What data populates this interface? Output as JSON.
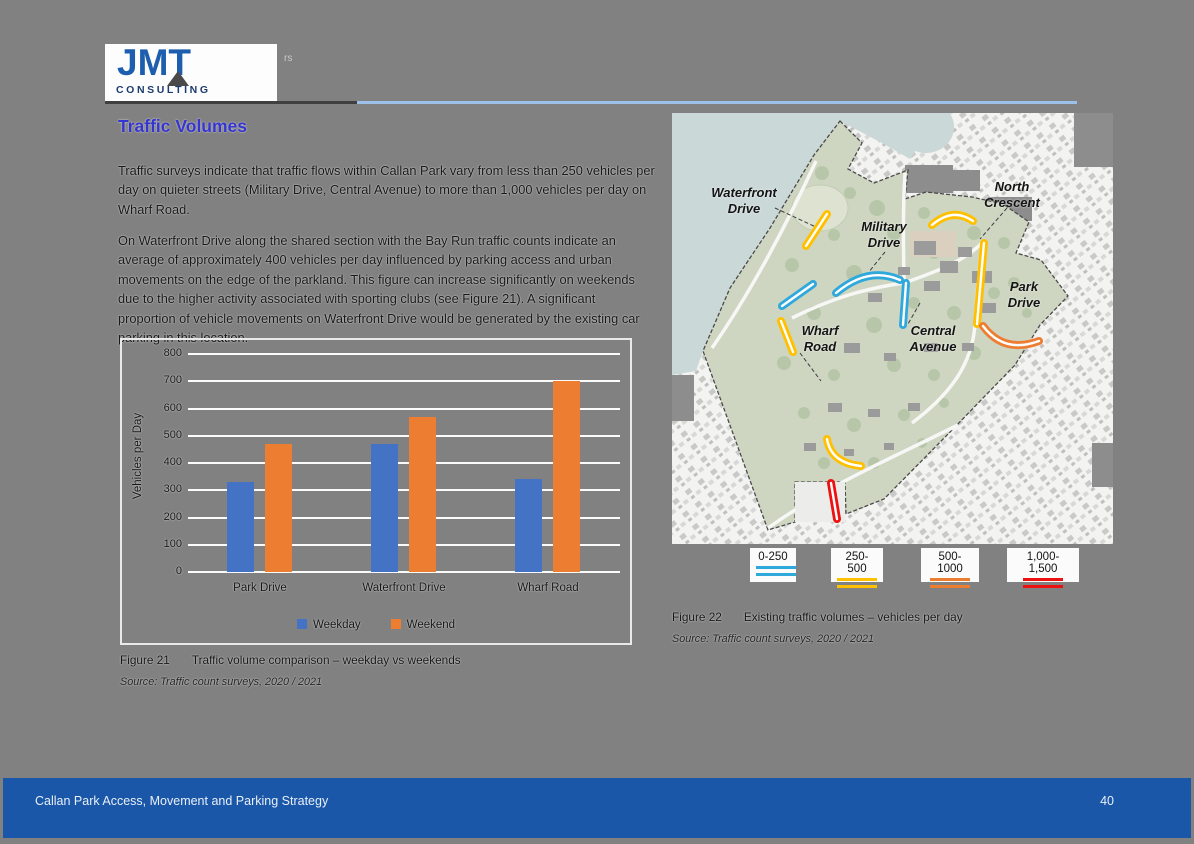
{
  "logo": {
    "brand": "JMT",
    "subtitle": "CONSULTING",
    "artifact": "rs"
  },
  "article": {
    "title": "Traffic Volumes",
    "paragraphs": [
      "Traffic surveys indicate that traffic flows within Callan Park vary from less than 250 vehicles per day on quieter streets (Military Drive, Central Avenue) to more than 1,000 vehicles per day on Wharf Road.",
      "On Waterfront Drive along the shared section with the Bay Run traffic counts indicate an average of approximately 400 vehicles per day influenced by parking access and urban movements on the edge of the parkland. This figure can increase significantly on weekends due to the higher activity associated with sporting clubs (see Figure 21). A significant proportion of vehicle movements on Waterfront Drive would be generated by the existing car parking in this location."
    ]
  },
  "chart_data": {
    "type": "bar",
    "categories": [
      "Park Drive",
      "Waterfront Drive",
      "Wharf Road"
    ],
    "series": [
      {
        "name": "Weekday",
        "color": "#4472C4",
        "values": [
          330,
          470,
          340
        ]
      },
      {
        "name": "Weekend",
        "color": "#ED7D31",
        "values": [
          470,
          570,
          700
        ]
      }
    ],
    "title": "",
    "xlabel": "",
    "ylabel": "Vehicles per Day",
    "ylim": [
      0,
      800
    ],
    "ytick_step": 100,
    "grid": true,
    "legend_position": "bottom"
  },
  "figure21": {
    "label": "Figure 21",
    "caption": "Traffic volume comparison – weekday vs weekends",
    "source": "Source: Traffic count surveys, 2020 / 2021"
  },
  "map": {
    "labels": {
      "waterfront": {
        "line1": "Waterfront",
        "line2": "Drive"
      },
      "military": {
        "line1": "Military",
        "line2": "Drive"
      },
      "north": {
        "line1": "North",
        "line2": "Crescent"
      },
      "park": {
        "line1": "Park",
        "line2": "Drive"
      },
      "wharf": {
        "line1": "Wharf",
        "line2": "Road"
      },
      "central": {
        "line1": "Central",
        "line2": "Avenue"
      }
    },
    "legend": [
      {
        "label": "0-250",
        "color": "#2FA8DC"
      },
      {
        "label": "250-500",
        "color": "#FFC000"
      },
      {
        "label": "500-1000",
        "color": "#ED7D31"
      },
      {
        "label": "1,000-1,500",
        "color": "#EE1111"
      }
    ],
    "segments": [
      {
        "road": "Waterfront Drive",
        "range": "250-500"
      },
      {
        "road": "North Crescent",
        "range": "250-500"
      },
      {
        "road": "Park Drive (north)",
        "range": "250-500"
      },
      {
        "road": "Park Drive (south)",
        "range": "500-1000"
      },
      {
        "road": "Military Drive",
        "range": "0-250"
      },
      {
        "road": "Central Avenue",
        "range": "0-250"
      },
      {
        "road": "Wharf Road (north)",
        "range": "0-250"
      },
      {
        "road": "Wharf Road (mid)",
        "range": "250-500"
      },
      {
        "road": "South entrance",
        "range": "250-500"
      },
      {
        "road": "Wharf Road (south entry)",
        "range": "1,000-1,500"
      }
    ]
  },
  "figure22": {
    "label": "Figure 22",
    "caption": "Existing traffic volumes – vehicles per day",
    "source": "Source: Traffic count surveys, 2020 / 2021"
  },
  "footer": {
    "title": "Callan Park Access, Movement and Parking Strategy",
    "page_number": "40"
  }
}
